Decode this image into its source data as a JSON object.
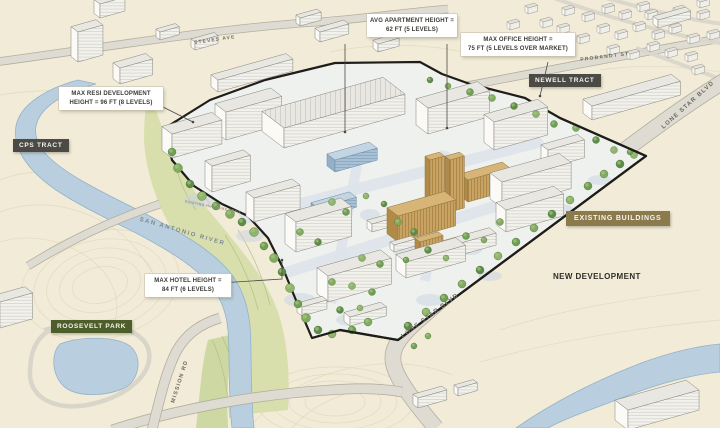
{
  "title": "Lone Star District Masterplan Rendering",
  "callouts": {
    "apartment": {
      "line1": "AVG APARTMENT HEIGHT =",
      "line2": "62 FT (5 LEVELS)"
    },
    "office": {
      "line1": "MAX OFFICE HEIGHT =",
      "line2": "75 FT (5 LEVELS OVER MARKET)"
    },
    "resi": {
      "line1": "MAX RESI DEVELOPMENT",
      "line2": "HEIGHT = 96 FT (8 LEVELS)"
    },
    "hotel": {
      "line1": "MAX HOTEL HEIGHT =",
      "line2": "84 FT (6 LEVELS)"
    }
  },
  "badges": {
    "cps_tract": "CPS TRACT",
    "newell_tract": "NEWELL TRACT",
    "roosevelt_park": "ROOSEVELT PARK",
    "existing_buildings": "EXISTING BUILDINGS",
    "new_development": "NEW DEVELOPMENT"
  },
  "road_labels": {
    "steves_ave": "STEVES AVE",
    "probandt_st": "PROBANDT ST",
    "lone_star_blvd_right": "LONE STAR BLVD",
    "lone_star_blvd_bottom": "LONE STAR BLVD",
    "mission_rd": "MISSION RD",
    "san_antonio_river": "SAN ANTONIO RIVER",
    "hike_bike_trail": "EXISTING HIKE/BIKE TRAIL"
  },
  "colors": {
    "background": "#f1ebd8",
    "contour": "#e2d8ba",
    "greenbelt": "#d8dfad",
    "green_hatch": "#abbe80",
    "river": "#b9cfdf",
    "river_edge": "#93b2c9",
    "road": "#dedbd2",
    "road_edge": "#b5ae9e",
    "site_ground": "#eff1ee",
    "site_path": "#dde3ea",
    "tree_shadow": "#c7d3e2",
    "boundary": "#1e1d1a",
    "leader": "#4a4844",
    "new_building_front": "#f2f1ec",
    "new_building_side": "#fbfaf7",
    "new_building_roof": "#e9e7e1",
    "building_stroke": "#84837b",
    "existing_front": "#c8a364",
    "existing_side": "#b18a47",
    "existing_roof": "#d6b577",
    "existing_stroke": "#8f7440",
    "glass_front": "#a7c0d6",
    "glass_side": "#93b0c9",
    "glass_roof": "#c3d4e2",
    "badge_dark": "#4b4a45",
    "badge_green": "#4e5e2a",
    "badge_tan": "#8b7a4b",
    "callout_bg": "#ffffff",
    "callout_text": "#3b3a36"
  }
}
